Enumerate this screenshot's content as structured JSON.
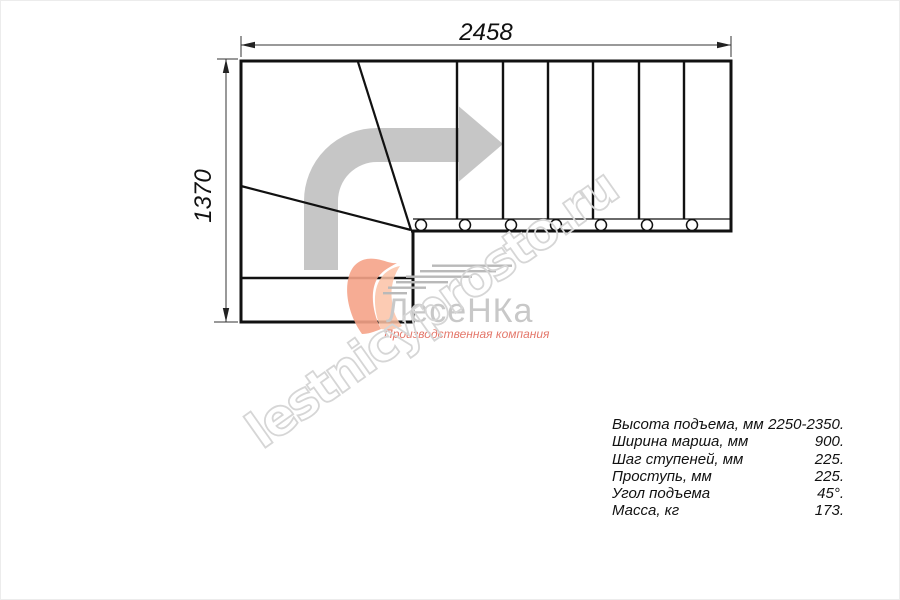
{
  "drawing": {
    "dimension_top": "2458",
    "dimension_left": "1370"
  },
  "watermark": {
    "text": "lestnicyprosto.ru"
  },
  "logo": {
    "brand": "ЛесеНКа",
    "subtitle": "Производственная компания"
  },
  "specs": {
    "rows": [
      {
        "label": "Высота подъема, мм",
        "value": "2250-2350."
      },
      {
        "label": "Ширина марша, мм",
        "value": "900."
      },
      {
        "label": "Шаг ступеней, мм",
        "value": "225."
      },
      {
        "label": "Проступь, мм",
        "value": "225."
      },
      {
        "label": "Угол подъема",
        "value": "45°."
      },
      {
        "label": "Масса, кг",
        "value": "173."
      }
    ]
  },
  "colors": {
    "line": "#111111",
    "dimension": "#333333",
    "direction_arrow": "#c6c6c6",
    "watermark_stroke": "#d6d6d6",
    "logo_brand_gray": "#c8c8c8",
    "logo_orange": "#f5a388",
    "logo_subtitle_red": "#e4786b"
  }
}
